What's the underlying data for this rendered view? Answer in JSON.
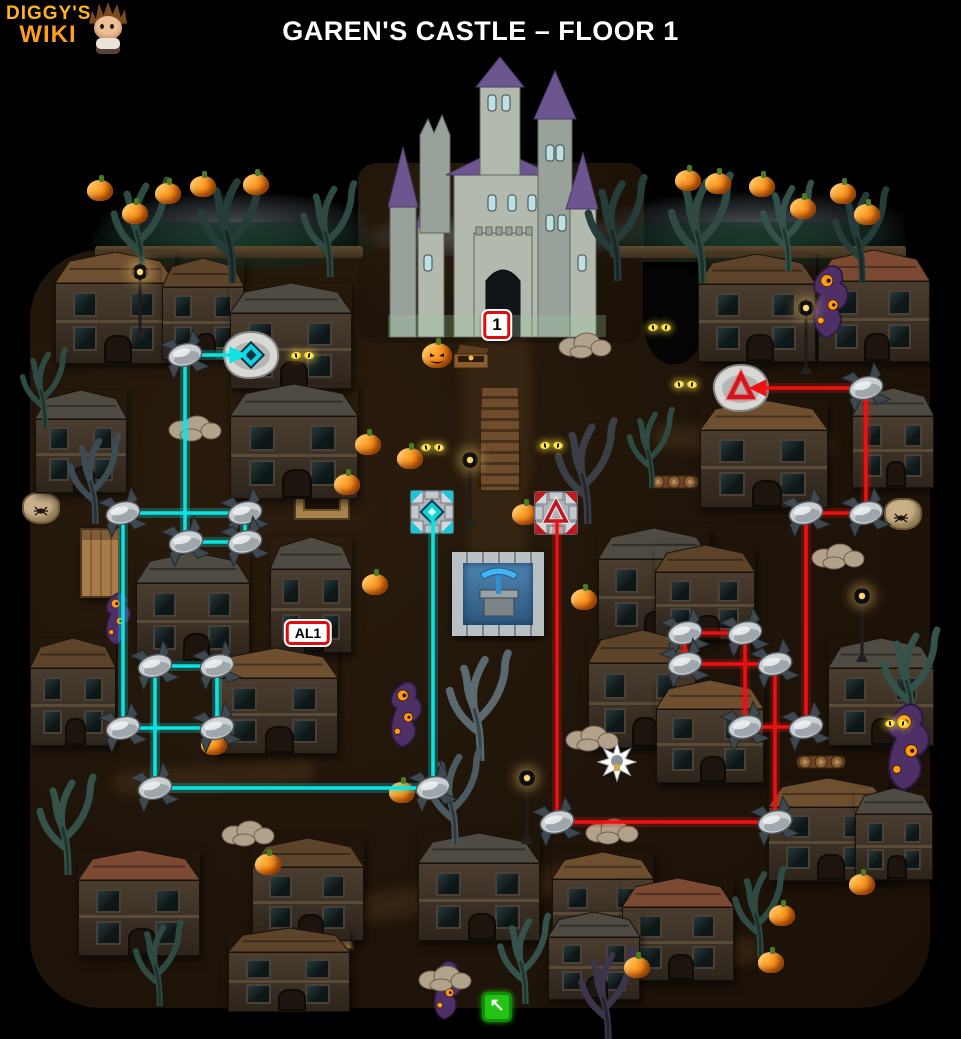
{
  "header": {
    "logo": {
      "line1": "DIGGY'S",
      "line2": "WIKI"
    },
    "title": "GAREN'S CASTLE – FLOOR 1"
  },
  "colors": {
    "background": "#000000",
    "ground": "#20150a",
    "logo_orange": "#ffb520",
    "title_white": "#ffffff",
    "cyan_path": "#0ce4e4",
    "red_path": "#ec1212",
    "marker_border": "#e00b0b",
    "marker_bg": "#ffffff",
    "exit_green": "#23c414",
    "castle_roof_purple": "#6d5590",
    "castle_wall_gray": "#b2baae"
  },
  "markers": {
    "castle_floor": {
      "label": "1",
      "x": 497,
      "y": 325
    },
    "alcove": {
      "label": "AL1",
      "x": 308,
      "y": 633
    },
    "exit": {
      "glyph": "↖",
      "x": 497,
      "y": 1007
    }
  },
  "paths": {
    "cyan": {
      "color": "#0ce4e4",
      "segments": [
        [
          185,
          355,
          234,
          355,
          1
        ],
        [
          185,
          355,
          185,
          542,
          0
        ],
        [
          123,
          513,
          245,
          513,
          0
        ],
        [
          245,
          513,
          245,
          542,
          0
        ],
        [
          186,
          542,
          245,
          542,
          0
        ],
        [
          123,
          513,
          123,
          728,
          0
        ],
        [
          123,
          728,
          217,
          728,
          0
        ],
        [
          155,
          666,
          217,
          666,
          0
        ],
        [
          217,
          666,
          217,
          728,
          0
        ],
        [
          155,
          666,
          155,
          788,
          0
        ],
        [
          155,
          788,
          433,
          788,
          0
        ],
        [
          433,
          788,
          433,
          518,
          0
        ]
      ],
      "nodes": [
        [
          185,
          355
        ],
        [
          123,
          513
        ],
        [
          245,
          513
        ],
        [
          186,
          542
        ],
        [
          245,
          542
        ],
        [
          123,
          728
        ],
        [
          217,
          728
        ],
        [
          155,
          666
        ],
        [
          217,
          666
        ],
        [
          155,
          788
        ],
        [
          433,
          788
        ]
      ],
      "portal_stone": [
        251,
        355
      ],
      "portal_tile": [
        432,
        512
      ]
    },
    "red": {
      "color": "#ec1212",
      "segments": [
        [
          866,
          388,
          762,
          388,
          1
        ],
        [
          866,
          388,
          866,
          513,
          0
        ],
        [
          866,
          513,
          806,
          513,
          0
        ],
        [
          806,
          513,
          806,
          727,
          0
        ],
        [
          806,
          727,
          745,
          727,
          0
        ],
        [
          745,
          727,
          745,
          633,
          0
        ],
        [
          745,
          633,
          685,
          633,
          0
        ],
        [
          685,
          633,
          685,
          664,
          0
        ],
        [
          685,
          664,
          775,
          664,
          0
        ],
        [
          775,
          664,
          775,
          822,
          0
        ],
        [
          775,
          822,
          557,
          822,
          0
        ],
        [
          557,
          822,
          557,
          522,
          0
        ]
      ],
      "nodes": [
        [
          866,
          388
        ],
        [
          866,
          513
        ],
        [
          806,
          513
        ],
        [
          685,
          633
        ],
        [
          745,
          633
        ],
        [
          685,
          664
        ],
        [
          775,
          664
        ],
        [
          745,
          727
        ],
        [
          806,
          727
        ],
        [
          557,
          822
        ],
        [
          775,
          822
        ]
      ],
      "portal_stone": [
        741,
        388
      ],
      "portal_tile": [
        556,
        513
      ]
    }
  },
  "decor": {
    "ground": {
      "main": [
        30,
        250,
        900,
        758,
        70
      ],
      "courtyard": [
        358,
        163,
        286,
        180,
        18
      ]
    },
    "trails": [
      [
        462,
        338,
        70,
        150,
        0
      ],
      [
        468,
        468,
        58,
        112,
        0
      ],
      [
        352,
        878,
        244,
        30,
        -8
      ],
      [
        556,
        928,
        204,
        28,
        6
      ],
      [
        652,
        428,
        184,
        26,
        3
      ],
      [
        112,
        764,
        204,
        26,
        -4
      ]
    ],
    "walls": [
      [
        95,
        246,
        268,
        12
      ],
      [
        610,
        246,
        296,
        12
      ]
    ],
    "clouds": [
      [
        100,
        192,
        268,
        58
      ],
      [
        606,
        192,
        298,
        58
      ],
      [
        360,
        212,
        284,
        44
      ]
    ],
    "canopies": [
      [
        92,
        222,
        280,
        48
      ],
      [
        600,
        222,
        306,
        48
      ]
    ],
    "pit": [
      643,
      262,
      62,
      102
    ],
    "houses": [
      [
        55,
        252,
        120,
        112,
        "#6e4f30"
      ],
      [
        162,
        258,
        82,
        102,
        "#5d432a"
      ],
      [
        230,
        283,
        122,
        106,
        "#4f4a42"
      ],
      [
        698,
        254,
        118,
        108,
        "#5d432a"
      ],
      [
        818,
        250,
        112,
        112,
        "#7c4a33"
      ],
      [
        35,
        390,
        92,
        103,
        "#4f4a42"
      ],
      [
        230,
        384,
        128,
        115,
        "#4f4a42"
      ],
      [
        700,
        400,
        128,
        108,
        "#6e4f30"
      ],
      [
        852,
        388,
        82,
        100,
        "#4f4a42"
      ],
      [
        30,
        638,
        86,
        108,
        "#5d432a"
      ],
      [
        136,
        552,
        114,
        110,
        "#4f4a42"
      ],
      [
        270,
        537,
        82,
        116,
        "#4f4a42"
      ],
      [
        214,
        648,
        124,
        106,
        "#6e4f30"
      ],
      [
        598,
        528,
        112,
        112,
        "#4f4a42"
      ],
      [
        655,
        545,
        100,
        95,
        "#5d432a"
      ],
      [
        588,
        630,
        108,
        118,
        "#5d432a"
      ],
      [
        656,
        680,
        108,
        103,
        "#6e4f30"
      ],
      [
        828,
        638,
        106,
        108,
        "#4f4a42"
      ],
      [
        768,
        778,
        120,
        103,
        "#6e4f30"
      ],
      [
        855,
        788,
        78,
        92,
        "#4f4a42"
      ],
      [
        78,
        850,
        122,
        106,
        "#7c4a33"
      ],
      [
        252,
        838,
        112,
        103,
        "#5d432a"
      ],
      [
        418,
        833,
        122,
        108,
        "#4f4a42"
      ],
      [
        552,
        852,
        102,
        98,
        "#6e4f30"
      ],
      [
        622,
        878,
        112,
        103,
        "#7c4a33"
      ],
      [
        228,
        928,
        122,
        84,
        "#5d432a"
      ],
      [
        548,
        912,
        92,
        88,
        "#4f4a42"
      ]
    ],
    "pumpkins": [
      [
        100,
        190
      ],
      [
        135,
        213
      ],
      [
        168,
        193
      ],
      [
        203,
        186
      ],
      [
        256,
        184
      ],
      [
        688,
        180
      ],
      [
        718,
        183
      ],
      [
        762,
        186
      ],
      [
        803,
        208
      ],
      [
        843,
        193
      ],
      [
        867,
        214
      ],
      [
        347,
        484
      ],
      [
        410,
        458
      ],
      [
        368,
        444
      ],
      [
        525,
        514
      ],
      [
        584,
        599
      ],
      [
        375,
        584
      ],
      [
        214,
        744
      ],
      [
        402,
        792
      ],
      [
        268,
        864
      ],
      [
        862,
        884
      ],
      [
        782,
        915
      ],
      [
        771,
        962
      ],
      [
        637,
        967
      ]
    ],
    "jack_o_lantern": [
      437,
      355
    ],
    "eyes": [
      [
        303,
        356
      ],
      [
        660,
        328
      ],
      [
        686,
        385
      ],
      [
        433,
        448
      ],
      [
        552,
        446
      ],
      [
        897,
        724
      ]
    ],
    "lampposts": [
      [
        140,
        262
      ],
      [
        470,
        450
      ],
      [
        527,
        768
      ],
      [
        806,
        298
      ],
      [
        862,
        586
      ]
    ],
    "trees": [
      [
        142,
        168,
        "#2e4a42",
        1
      ],
      [
        232,
        162,
        "#253c38",
        1.1
      ],
      [
        330,
        172,
        "#2e4a42",
        0.95
      ],
      [
        618,
        165,
        "#253c38",
        1.05
      ],
      [
        702,
        162,
        "#2e4a42",
        1.1
      ],
      [
        788,
        172,
        "#34524a",
        0.9
      ],
      [
        862,
        178,
        "#253c38",
        0.95
      ],
      [
        95,
        425,
        "#3c4c52",
        0.9
      ],
      [
        588,
        408,
        "#3a3f45",
        1.05
      ],
      [
        652,
        400,
        "#2e4a42",
        0.8
      ],
      [
        480,
        640,
        "#5a6a70",
        1.1
      ],
      [
        455,
        740,
        "#4a5a60",
        0.95
      ],
      [
        68,
        765,
        "#34524a",
        1.0
      ],
      [
        160,
        912,
        "#2e4a42",
        0.85
      ],
      [
        525,
        905,
        "#34524a",
        0.9
      ],
      [
        608,
        938,
        "#3c3448",
        0.95
      ],
      [
        760,
        858,
        "#2e4a42",
        0.9
      ],
      [
        912,
        618,
        "#34524a",
        1.0
      ],
      [
        45,
        340,
        "#2e4a42",
        0.8
      ]
    ],
    "monsters": [
      [
        800,
        252,
        52,
        92
      ],
      [
        872,
        690,
        62,
        105
      ],
      [
        378,
        672,
        48,
        78
      ],
      [
        418,
        952,
        52,
        70
      ],
      [
        95,
        585,
        40,
        62
      ]
    ],
    "rocks": [
      [
        195,
        425
      ],
      [
        585,
        342
      ],
      [
        592,
        735
      ],
      [
        838,
        553
      ],
      [
        248,
        830
      ],
      [
        445,
        975
      ],
      [
        612,
        828
      ]
    ],
    "spiders": [
      [
        893,
        512
      ],
      [
        33,
        505
      ],
      [
        748,
        360
      ]
    ],
    "sacks": [
      [
        884,
        498
      ],
      [
        22,
        492
      ]
    ],
    "crates": [
      [
        296,
        470
      ],
      [
        300,
        900
      ]
    ],
    "log_piles": [
      [
        648,
        468
      ],
      [
        795,
        748
      ]
    ],
    "cabinet": [
      80,
      528
    ],
    "burst": [
      617,
      762
    ],
    "fountain": [
      452,
      552
    ],
    "bridge": [
      478,
      388
    ],
    "chest": [
      450,
      342
    ]
  }
}
